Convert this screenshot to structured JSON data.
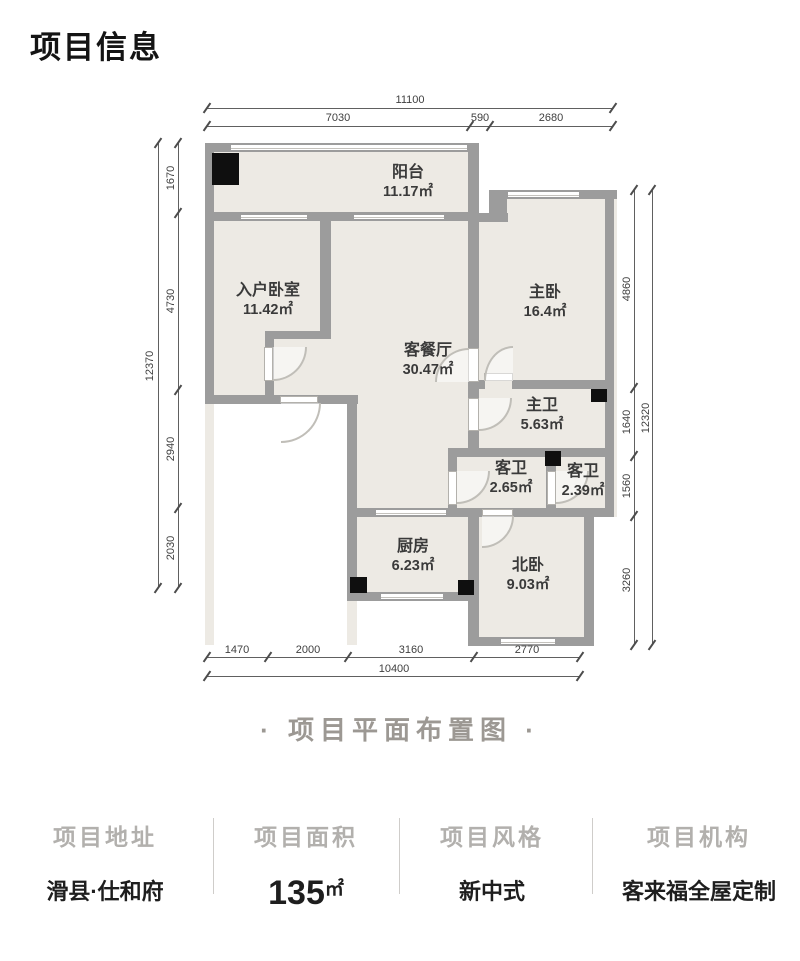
{
  "colors": {
    "floor": "#edeae4",
    "wall": "#9c9c9c",
    "column_block": "#0f0f0f",
    "dim_text": "#3f3f3f",
    "muted_caption": "#9c9893",
    "info_label": "#b2b0ad",
    "info_value": "#1e1e1e"
  },
  "header": {
    "title": "项目信息"
  },
  "plan": {
    "rooms": [
      {
        "name": "阳台",
        "area": "11.17㎡"
      },
      {
        "name": "入户卧室",
        "area": "11.42㎡"
      },
      {
        "name": "客餐厅",
        "area": "30.47㎡"
      },
      {
        "name": "主卧",
        "area": "16.4㎡"
      },
      {
        "name": "主卫",
        "area": "5.63㎡"
      },
      {
        "name": "客卫",
        "area": "2.65㎡"
      },
      {
        "name": "客卫",
        "area": "2.39㎡"
      },
      {
        "name": "厨房",
        "area": "6.23㎡"
      },
      {
        "name": "北卧",
        "area": "9.03㎡"
      }
    ],
    "dims": {
      "top_total": "11100",
      "top": [
        "7030",
        "590",
        "2680"
      ],
      "left_total": "12370",
      "left": [
        "1670",
        "4730",
        "2940",
        "2030"
      ],
      "right_total": "12320",
      "right": [
        "4860",
        "1640",
        "1560",
        "3260"
      ],
      "bottom_total": "10400",
      "bottom": [
        "1470",
        "2000",
        "3160",
        "2770"
      ]
    }
  },
  "caption": {
    "text": "·  项目平面布置图  ·"
  },
  "info": {
    "columns": [
      {
        "label": "项目地址",
        "value": "滑县·仕和府",
        "unit": ""
      },
      {
        "label": "项目面积",
        "value": "135",
        "unit": "㎡"
      },
      {
        "label": "项目风格",
        "value": "新中式",
        "unit": ""
      },
      {
        "label": "项目机构",
        "value": "客来福全屋定制",
        "unit": ""
      }
    ]
  }
}
